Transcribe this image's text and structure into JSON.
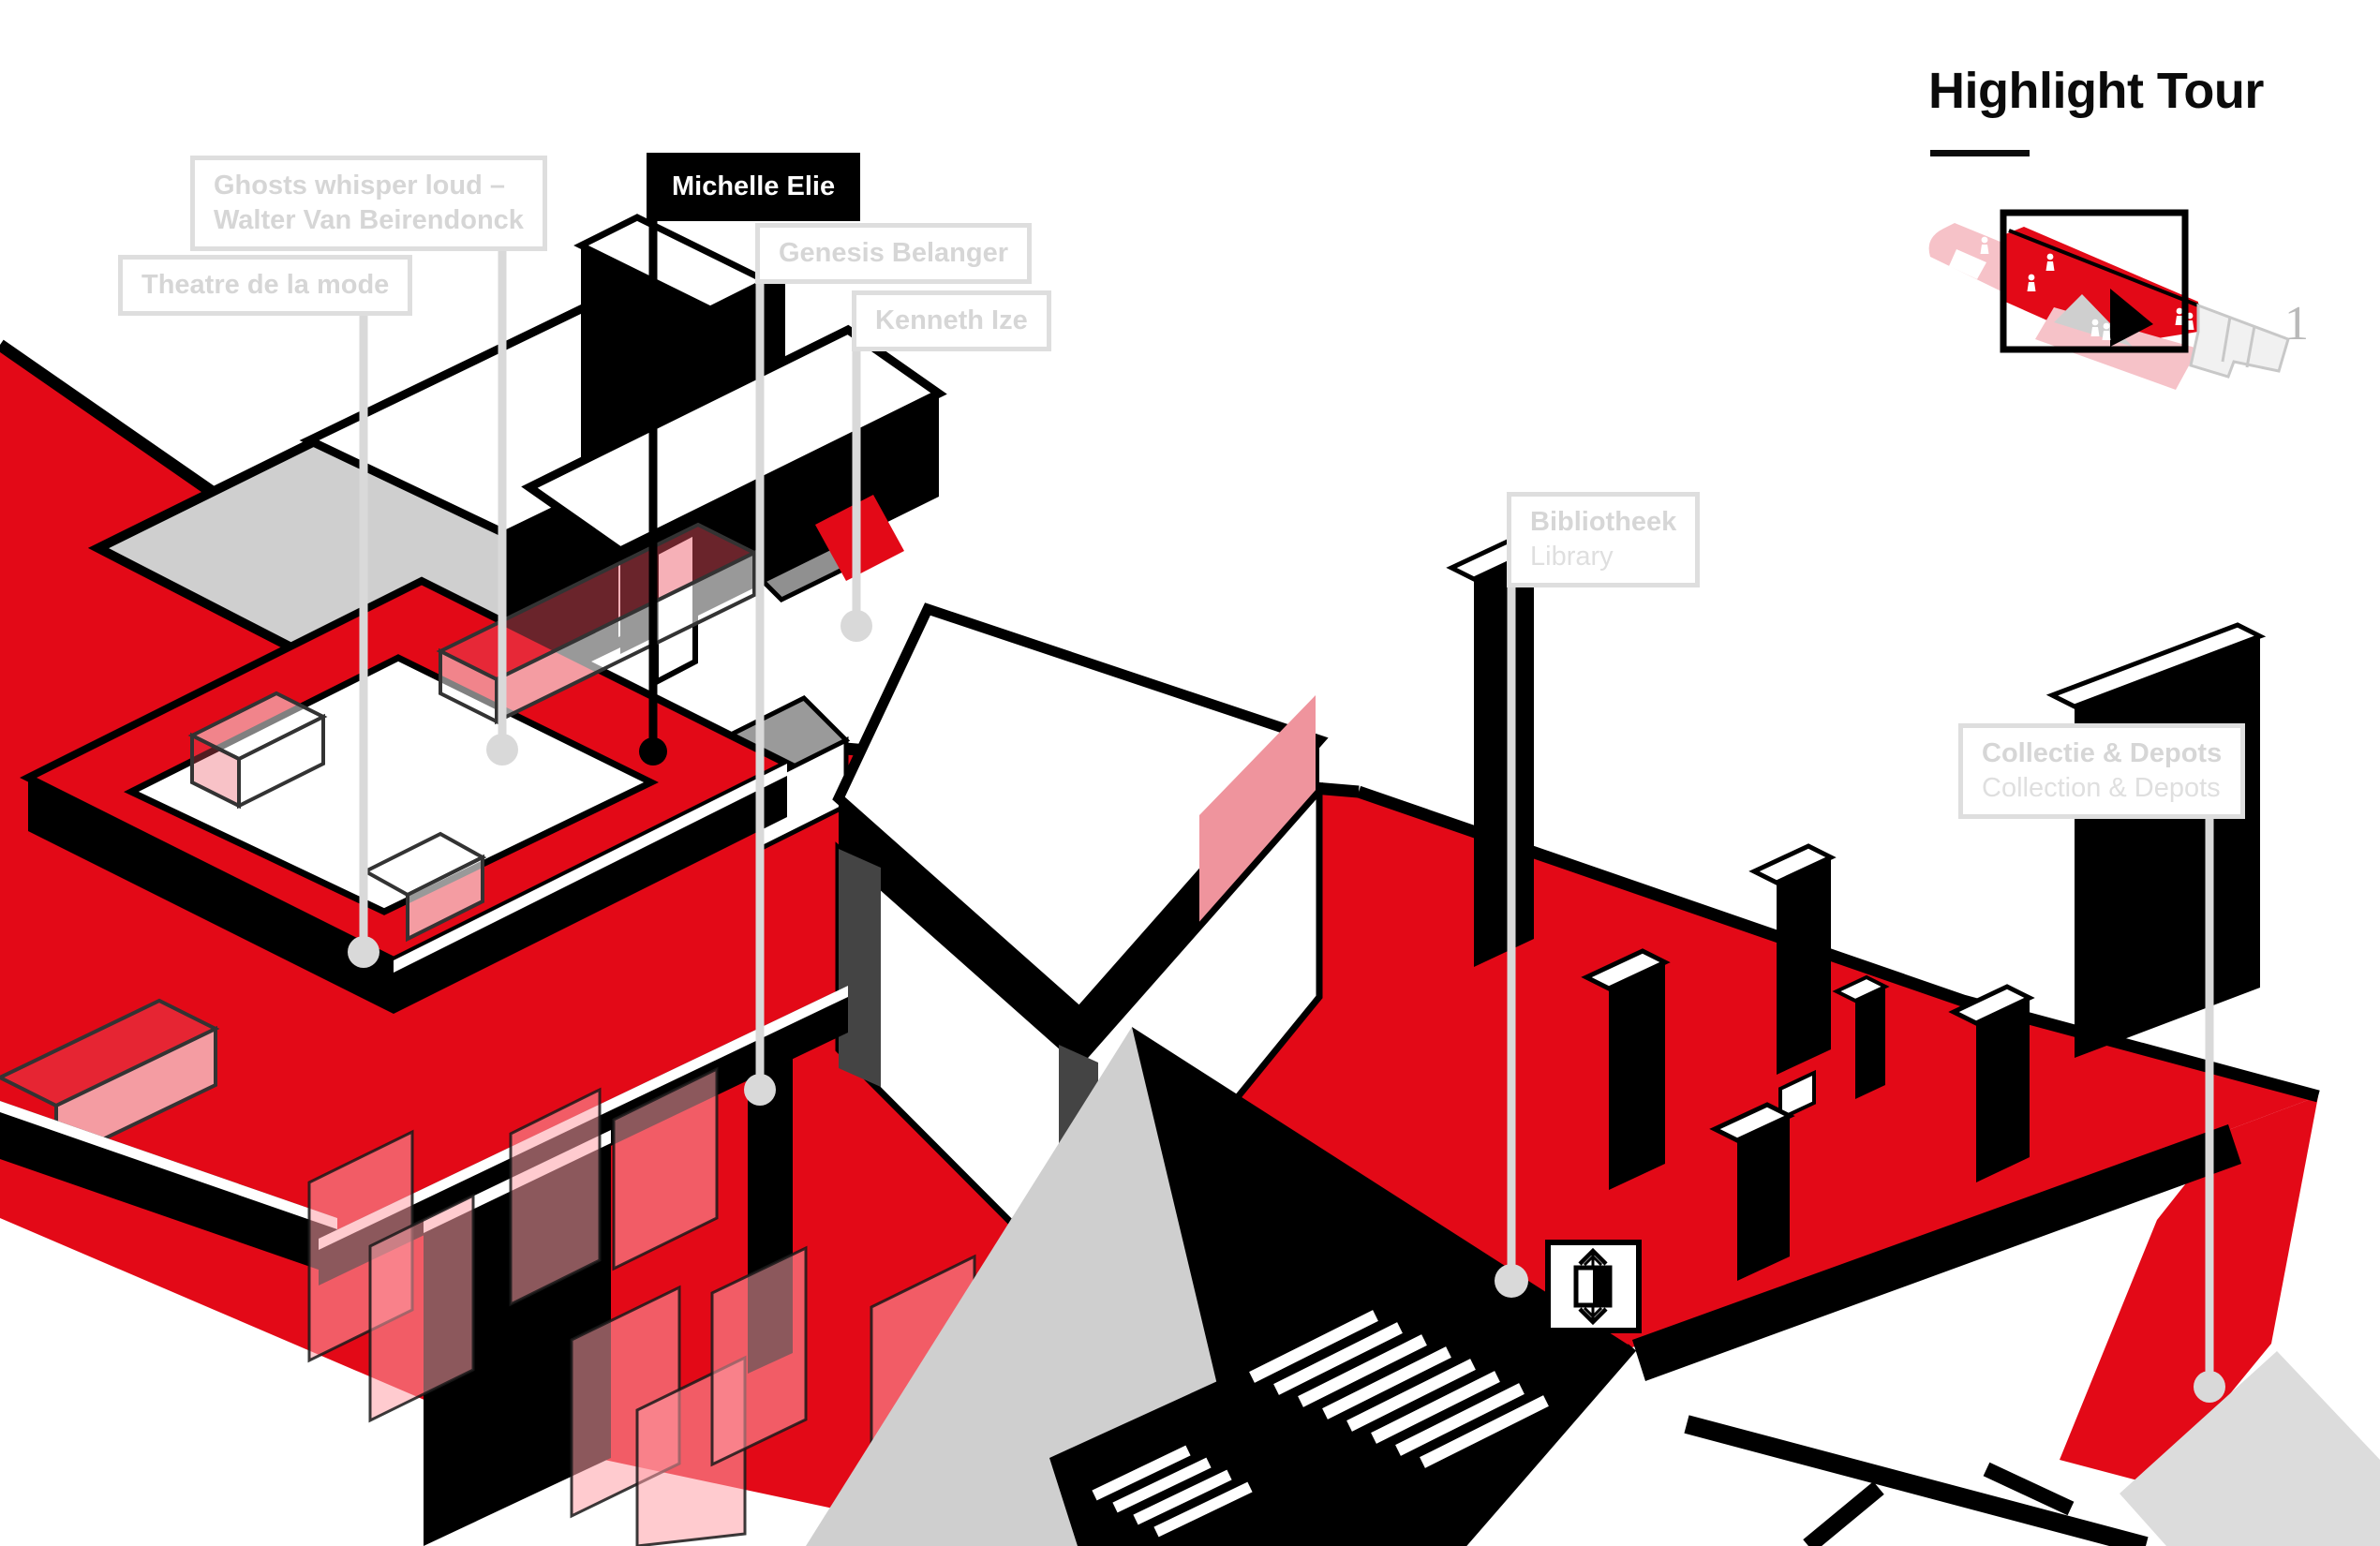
{
  "header": {
    "title": "Highlight Tour"
  },
  "minimap": {
    "floor_label": "1"
  },
  "icons": {
    "elevator": "elevator-up-down-symbol",
    "person": "visitor-figure"
  },
  "tour": {
    "stops": [
      {
        "id": "ghosts-whisper-loud",
        "line1": "Ghosts whisper loud –",
        "line2": "Walter Van Beirendonck",
        "state": "inactive"
      },
      {
        "id": "theatre-de-la-mode",
        "line1": "Theatre de la mode",
        "state": "inactive"
      },
      {
        "id": "michelle-elie",
        "line1": "Michelle Elie",
        "state": "active"
      },
      {
        "id": "genesis-belanger",
        "line1": "Genesis Belanger",
        "state": "inactive"
      },
      {
        "id": "kenneth-ize",
        "line1": "Kenneth Ize",
        "state": "inactive"
      },
      {
        "id": "bibliotheek",
        "line1": "Bibliotheek",
        "line2": "Library",
        "state": "inactive"
      },
      {
        "id": "collectie-depots",
        "line1": "Collectie & Depots",
        "line2": "Collection & Depots",
        "state": "inactive"
      }
    ]
  },
  "colors": {
    "accent_red": "#e30917",
    "active_label_bg": "#000000",
    "inactive_label_gray": "#d9d9d9",
    "floor_gray": "#cfcfcf",
    "glass_pink": "#f5a6ad",
    "minimap_pink": "#f6c2c8",
    "minimap_number_gray": "#b9b9b9"
  }
}
